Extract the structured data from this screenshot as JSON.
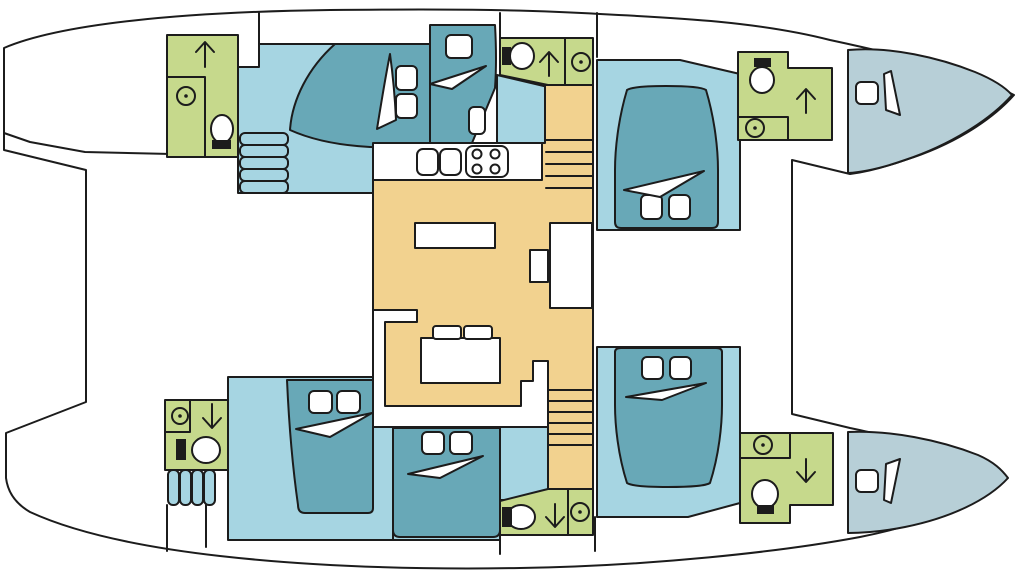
{
  "diagram": {
    "type": "yacht-floor-plan",
    "subject": "catamaran interior layout, top-down view, bow to the right",
    "palette": {
      "outline": "#1c1c1c",
      "deck": "#ffffff",
      "bathroom": "#c6d98c",
      "cabin_floor": "#a6d5e2",
      "bed": "#68a8b7",
      "bow_berth": "#b7cfd7",
      "salon": "#f2d28f"
    },
    "rooms": [
      {
        "id": "upper-aft-bathroom",
        "features": [
          "shower-up-arrow",
          "washbasin",
          "toilet"
        ]
      },
      {
        "id": "upper-aft-cabin",
        "features": [
          "double-bed",
          "entry-steps"
        ]
      },
      {
        "id": "upper-mid-berth",
        "features": [
          "single-berth",
          "pillow"
        ]
      },
      {
        "id": "upper-mid-bathroom",
        "features": [
          "toilet",
          "shower-up-arrow",
          "washbasin"
        ]
      },
      {
        "id": "upper-fore-cabin",
        "features": [
          "double-bed",
          "companionway-stairs"
        ]
      },
      {
        "id": "upper-fore-bathroom",
        "features": [
          "toilet",
          "shower-up-arrow",
          "washbasin"
        ]
      },
      {
        "id": "upper-bow-berth",
        "features": [
          "crew-berth",
          "pillow"
        ]
      },
      {
        "id": "salon",
        "features": [
          "galley-counter",
          "twin-sinks",
          "stove",
          "sideboard",
          "nav-station",
          "u-shaped-sofa",
          "table"
        ]
      },
      {
        "id": "lower-aft-bathroom",
        "features": [
          "washbasin",
          "shower-down-arrow",
          "toilet",
          "entry-steps"
        ]
      },
      {
        "id": "lower-aft-cabin",
        "features": [
          "double-bed"
        ]
      },
      {
        "id": "lower-mid-cabin",
        "features": [
          "double-bed",
          "companionway-stairs"
        ]
      },
      {
        "id": "lower-mid-bathroom",
        "features": [
          "toilet",
          "shower-down-arrow",
          "washbasin"
        ]
      },
      {
        "id": "lower-fore-cabin",
        "features": [
          "double-bed"
        ]
      },
      {
        "id": "lower-fore-bathroom",
        "features": [
          "washbasin",
          "shower-down-arrow",
          "toilet"
        ]
      },
      {
        "id": "lower-bow-berth",
        "features": [
          "crew-berth",
          "pillow"
        ]
      }
    ],
    "fixture_icons": [
      "toilet-icon",
      "washbasin-icon",
      "shower-arrow-icon",
      "stove-icon",
      "galley-sink-icon",
      "bed-pillow-icon",
      "blanket-icon",
      "stairs-icon"
    ]
  }
}
